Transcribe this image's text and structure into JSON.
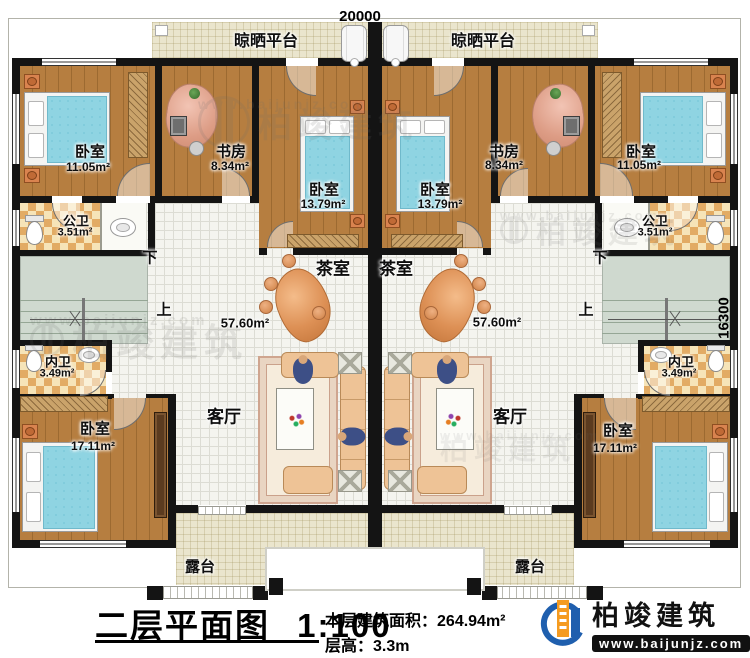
{
  "dimensions": {
    "width_top": "20000",
    "depth_right": "16300"
  },
  "title_block": {
    "title": "二层平面图",
    "scale": "1:100",
    "area_label": "本层建筑面积：",
    "area_value": "264.94m²",
    "floor_height_label": "层高：",
    "floor_height_value": "3.3m"
  },
  "logo": {
    "company": "柏竣建筑",
    "website": "www.baijunjz.com"
  },
  "watermark": {
    "brand": "柏竣建筑",
    "website": "www.baijunjz.com"
  },
  "stairs": {
    "down": "下",
    "up": "上"
  },
  "rooms": {
    "drying_platform_left": {
      "label": "晾晒平台"
    },
    "drying_platform_right": {
      "label": "晾晒平台"
    },
    "bedroom_top_left": {
      "label": "卧室",
      "area": "11.05m²"
    },
    "study_left": {
      "label": "书房",
      "area": "8.34m²"
    },
    "bedroom_mid_left": {
      "label": "卧室",
      "area": "13.79m²"
    },
    "bedroom_mid_right": {
      "label": "卧室",
      "area": "13.79m²"
    },
    "study_right": {
      "label": "书房",
      "area": "8.34m²"
    },
    "bedroom_top_right": {
      "label": "卧室",
      "area": "11.05m²"
    },
    "public_bath_left": {
      "label": "公卫",
      "area": "3.51m²"
    },
    "public_bath_right": {
      "label": "公卫",
      "area": "3.51m²"
    },
    "tea_room_left": {
      "label": "茶室"
    },
    "tea_room_right": {
      "label": "茶室"
    },
    "hall_left": {
      "area": "57.60m²"
    },
    "hall_right": {
      "area": "57.60m²"
    },
    "inner_bath_left": {
      "label": "内卫",
      "area": "3.49m²"
    },
    "inner_bath_right": {
      "label": "内卫",
      "area": "3.49m²"
    },
    "bedroom_bottom_left": {
      "label": "卧室",
      "area": "17.11m²"
    },
    "bedroom_bottom_right": {
      "label": "卧室",
      "area": "17.11m²"
    },
    "living_left": {
      "label": "客厅"
    },
    "living_right": {
      "label": "客厅"
    },
    "terrace_left": {
      "label": "露台"
    },
    "terrace_right": {
      "label": "露台"
    }
  }
}
